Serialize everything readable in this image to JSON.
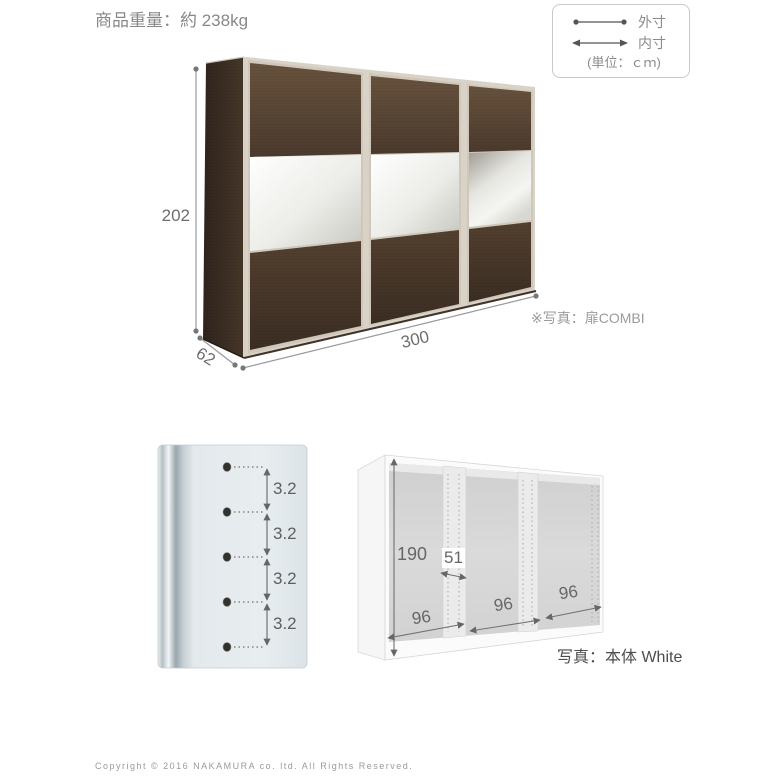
{
  "header": {
    "weight_label": "商品重量：約 238kg"
  },
  "legend": {
    "outer_label": "外寸",
    "inner_label": "内寸",
    "unit_label": "(単位：ｃｍ)"
  },
  "wardrobe_diagram": {
    "height_cm": "202",
    "width_cm": "300",
    "depth_cm": "62",
    "photo_note": "※写真：扉COMBI"
  },
  "pitch_diagram": {
    "pitch_labels": [
      "3.2",
      "3.2",
      "3.2",
      "3.2"
    ]
  },
  "frame_diagram": {
    "inner_height_cm": "190",
    "inner_depth_cm": "51",
    "inner_widths_cm": [
      "96",
      "96",
      "96"
    ],
    "photo_note": "写真：本体 White"
  },
  "footer": {
    "copyright": "Copyright © 2016 NAKAMURA co. ltd. All Rights Reserved."
  },
  "colors": {
    "wood_dark": "#3a2d22",
    "wood_mid": "#5a4634",
    "frame_silver": "#cfc7b9",
    "mirror_light": "#f4f4f0",
    "panel_blue_gray": "#e3e9ec",
    "interior_gray": "#d8d8d8",
    "dim_line": "#8a8a8a",
    "dim_text": "#6e6e6e",
    "note_text": "#9b9b9b"
  }
}
